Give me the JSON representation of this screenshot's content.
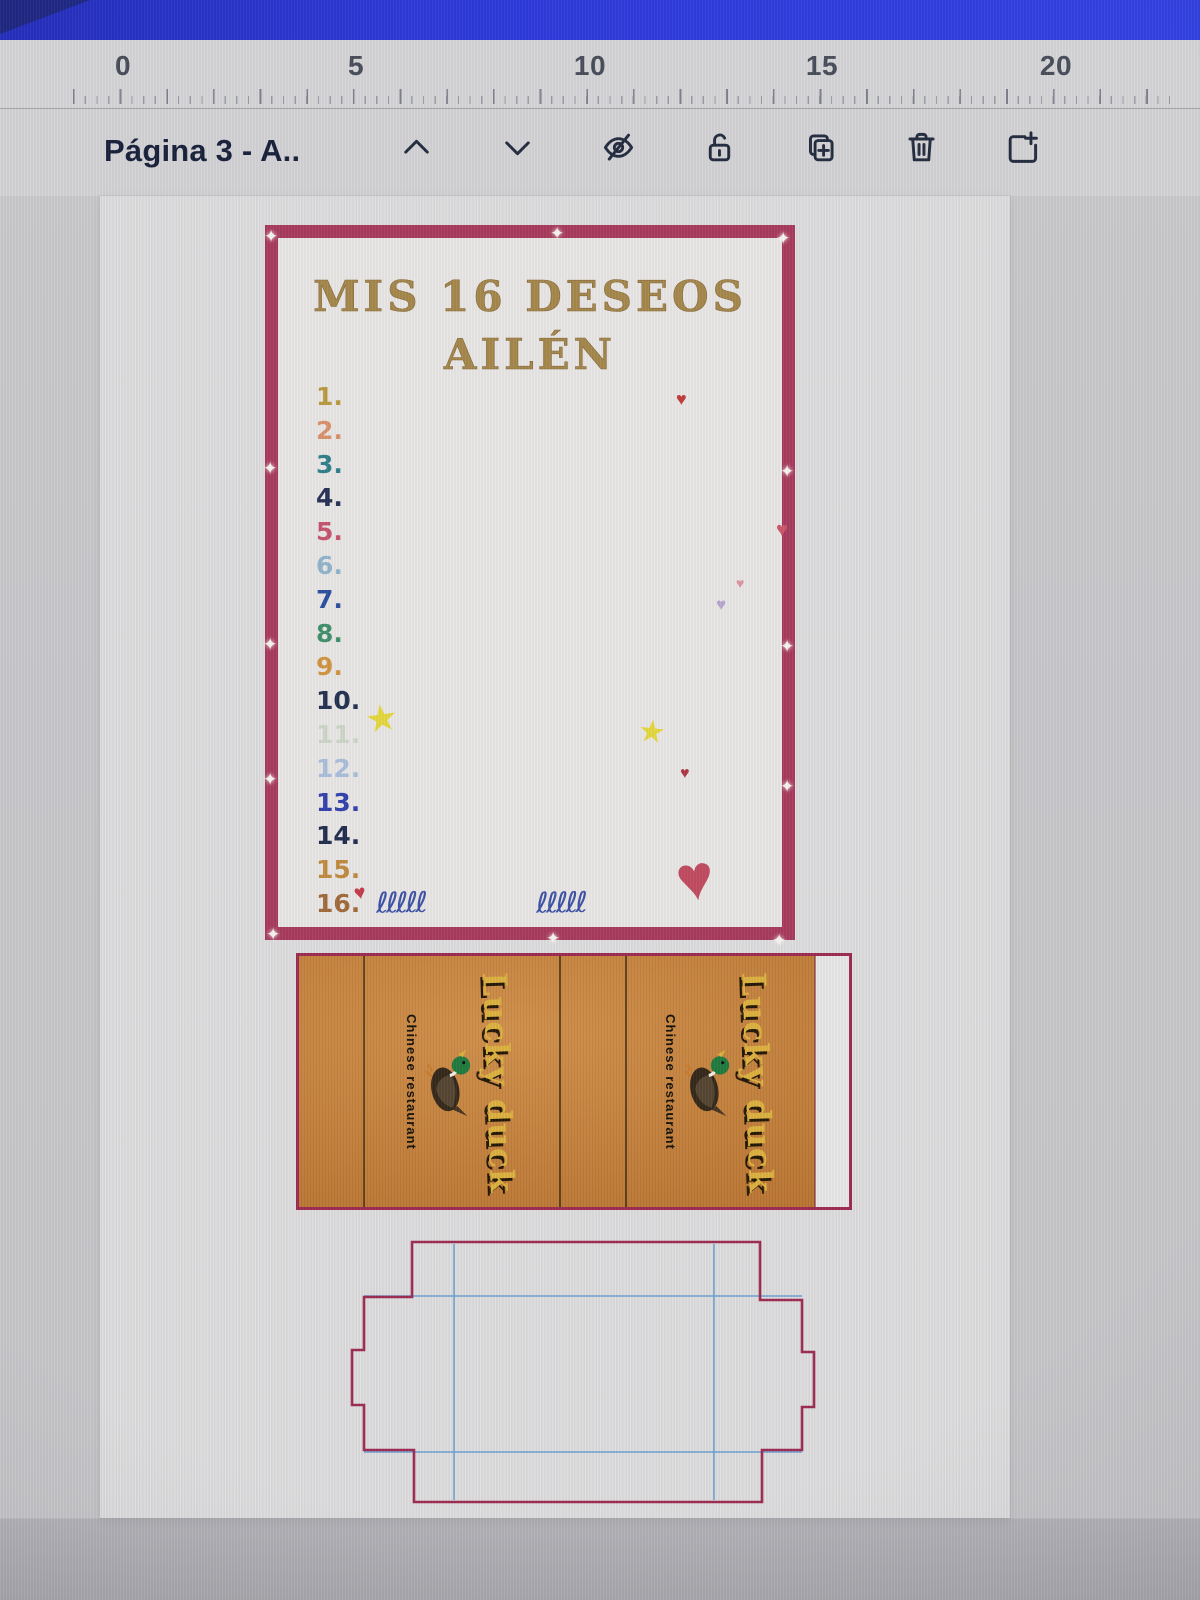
{
  "app": {
    "top_bar_color": "#2b38d8"
  },
  "ruler": {
    "marks": [
      "0",
      "5",
      "10",
      "15",
      "20"
    ]
  },
  "toolbar": {
    "page_label": "Página 3 - A..",
    "icons": [
      "chevron-up",
      "chevron-down",
      "hide",
      "lock-unlocked",
      "duplicate-page",
      "delete-page",
      "add-page"
    ]
  },
  "card": {
    "title_line1": "MIS 16 DESEOS",
    "title_line2": "AILÉN",
    "border_color": "#a73a5d",
    "title_color": "#a5874a",
    "wishes": [
      {
        "label": "1.",
        "color": "#b99a3e"
      },
      {
        "label": "2.",
        "color": "#d9906a"
      },
      {
        "label": "3.",
        "color": "#2e7f8a"
      },
      {
        "label": "4.",
        "color": "#253055"
      },
      {
        "label": "5.",
        "color": "#c4536d"
      },
      {
        "label": "6.",
        "color": "#8fb4cc"
      },
      {
        "label": "7.",
        "color": "#2b4e9e"
      },
      {
        "label": "8.",
        "color": "#3f8f6a"
      },
      {
        "label": "9.",
        "color": "#d09440"
      },
      {
        "label": "10.",
        "color": "#22304f"
      },
      {
        "label": "11.",
        "color": "#cdd5c8"
      },
      {
        "label": "12.",
        "color": "#a9bedb"
      },
      {
        "label": "13.",
        "color": "#3240ab"
      },
      {
        "label": "14.",
        "color": "#202c4e"
      },
      {
        "label": "15.",
        "color": "#c08a3e"
      },
      {
        "label": "16.",
        "color": "#a06a3a"
      }
    ],
    "icons": {
      "heart": "♥",
      "star": "★",
      "sparkle": "✦",
      "squiggle": "ℓℓℓℓℓ"
    }
  },
  "box": {
    "brand": "Lucky duck",
    "subtitle": "Chinese restaurant",
    "panel_color": "#c67c33",
    "outline_color": "#9c2950",
    "brand_color": "#dcb13e"
  },
  "dieline": {
    "outline_color": "#9c2950",
    "fold_color": "#6b9fd2"
  }
}
